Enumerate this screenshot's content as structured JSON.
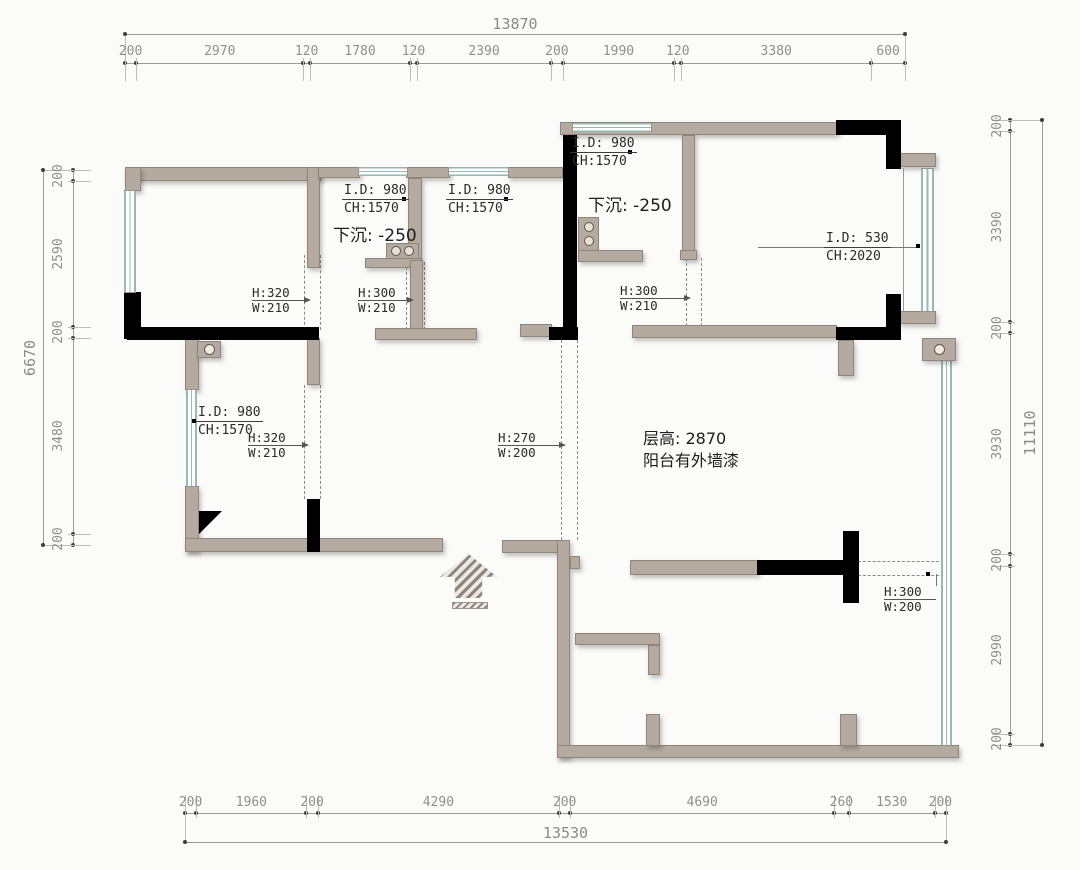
{
  "plan": {
    "dimension_chains": {
      "top": {
        "total": "13870",
        "segments": [
          "200",
          "2970",
          "120",
          "1780",
          "120",
          "2390",
          "200",
          "1990",
          "120",
          "3380",
          "600"
        ]
      },
      "left": {
        "total": "6670",
        "segments": [
          "200",
          "2590",
          "200",
          "3480",
          "200"
        ]
      },
      "right": {
        "total": "11110",
        "segments": [
          "200",
          "3390",
          "200",
          "3930",
          "200",
          "2990",
          "200"
        ]
      },
      "bottom": {
        "total": "13530",
        "segments": [
          "200",
          "1960",
          "200",
          "4290",
          "200",
          "4690",
          "260",
          "1530",
          "200"
        ]
      }
    },
    "window_labels": {
      "room_b": {
        "id": "I.D: 980",
        "ch": "CH:1570"
      },
      "room_c": {
        "id": "I.D: 980",
        "ch": "CH:1570"
      },
      "room_d": {
        "id": "I.D: 980",
        "ch": "CH:1570"
      },
      "room_e": {
        "id": "I.D: 980",
        "ch": "CH:1570"
      },
      "bay": {
        "id": "I.D: 530",
        "ch": "CH:2020"
      }
    },
    "sunken_notes": {
      "room_b": "下沉: -250",
      "room_d": "下沉: -250"
    },
    "beam_labels": {
      "b1": {
        "h": "H:320",
        "w": "W:210"
      },
      "b2": {
        "h": "H:300",
        "w": "W:210"
      },
      "b3": {
        "h": "H:300",
        "w": "W:210"
      },
      "b4": {
        "h": "H:320",
        "w": "W:210"
      },
      "b5": {
        "h": "H:270",
        "w": "W:200"
      },
      "b6": {
        "h": "H:300",
        "w": "W:200"
      }
    },
    "room_note": {
      "line1": "层高: 2870",
      "line2": "阳台有外墙漆"
    },
    "colors": {
      "wall": "#b4aaa0",
      "structural_wall": "#000000",
      "window": "#96b9b0",
      "dimension_text": "#8f8f8f",
      "label_text": "#2b2b2b"
    }
  }
}
